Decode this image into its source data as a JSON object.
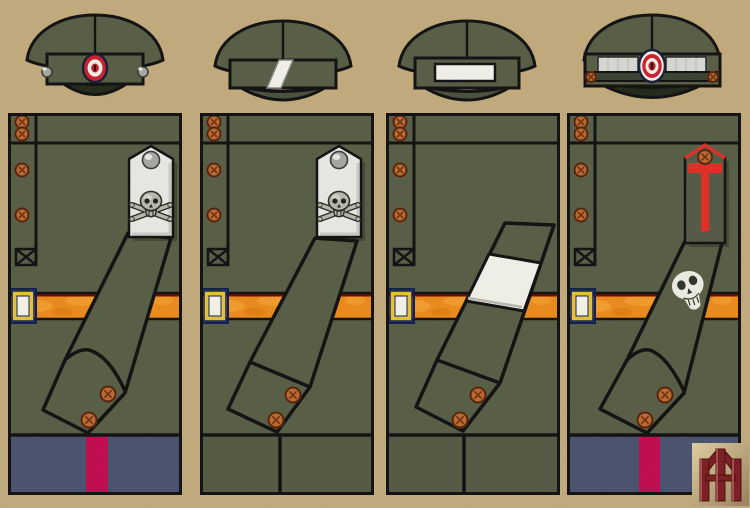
{
  "plate": {
    "description": "Four military uniform variants, each shown as a cap above a tunic panel",
    "figure_count": 4
  },
  "figures": [
    {
      "name": "figure-1",
      "cap": {
        "style": "peaked-cap",
        "visor": "dark",
        "cockade": true,
        "chin_strap": false,
        "band_buttons": "silver",
        "band_insignia": "none"
      },
      "tunic": {
        "shoulder_board": "silver-skull-crossbones",
        "cuff": "pointed",
        "armband": false,
        "sleeve_skull_patch": false,
        "belt": true
      },
      "trousers": {
        "style": "blue-with-crimson-stripe"
      }
    },
    {
      "name": "figure-2",
      "cap": {
        "style": "soft-cap",
        "visor": "green",
        "cockade": false,
        "chin_strap": false,
        "band_buttons": "none",
        "band_insignia": "white-diagonal-stripe"
      },
      "tunic": {
        "shoulder_board": "silver-skull-crossbones",
        "cuff": "straight",
        "armband": false,
        "sleeve_skull_patch": false,
        "belt": true
      },
      "trousers": {
        "style": "olive-plain"
      }
    },
    {
      "name": "figure-3",
      "cap": {
        "style": "soft-cap",
        "visor": "green",
        "cockade": false,
        "chin_strap": false,
        "band_buttons": "none",
        "band_insignia": "white-rectangle"
      },
      "tunic": {
        "shoulder_board": "none",
        "cuff": "straight",
        "armband": true,
        "sleeve_skull_patch": false,
        "belt": true
      },
      "trousers": {
        "style": "olive-plain"
      }
    },
    {
      "name": "figure-4",
      "cap": {
        "style": "peaked-cap",
        "visor": "dark",
        "cockade": true,
        "chin_strap": true,
        "band_buttons": "copper",
        "band_insignia": "silver-lace-panels"
      },
      "tunic": {
        "shoulder_board": "olive-with-red-T",
        "cuff": "pointed",
        "armband": false,
        "sleeve_skull_patch": true,
        "belt": true
      },
      "trousers": {
        "style": "blue-with-crimson-stripe"
      }
    }
  ],
  "monogram": {
    "present": true
  },
  "colors": {
    "background": "#c3ac7e",
    "outline": "#141414",
    "uniform_green": "#5a5f48",
    "visor_dark": "#262c1c",
    "visor_green": "#4c5340",
    "band_white": "#f2f1ea",
    "cockade_red": "#cd2330",
    "cockade_white": "#f3efe7",
    "cockade_navy": "#1b2238",
    "button_copper": "#bf6a33",
    "button_copper_dark": "#6f3413",
    "button_silver": "#a9a9a4",
    "board_silver": "#e9e9e5",
    "board_shadow": "rgba(20,20,10,0.28)",
    "skull_metal": "#b9baae",
    "skull_dark": "#2e2e28",
    "belt_orange": "#ec8c1e",
    "belt_orange_light": "#f7aa3c",
    "belt_orange_dark": "#d9790f",
    "belt_edge_dark": "#6e0d10",
    "buckle_gold": "#e7c33b",
    "buckle_navy": "#12225a",
    "buckle_white": "#f4f2e8",
    "trousers_blue": "#4d5470",
    "stripe_crimson": "#c30f52",
    "trousers_olive": "#565c45",
    "board_green": "#565c47",
    "board_red": "#e23028",
    "patch_white": "#ecece2",
    "armband_white": "#f1f1ea",
    "strap_green": "#3d4633",
    "lace_silver": "#d9d9d4",
    "monogram_red": "#7b2125",
    "monogram_light": "#b05a5e",
    "plaque_light": "#e2cfa2",
    "plaque_dark": "#9a845e"
  }
}
